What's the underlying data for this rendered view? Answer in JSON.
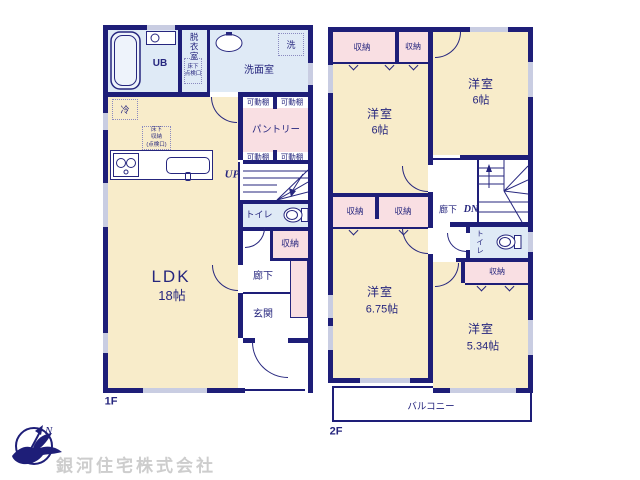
{
  "company": {
    "name": "銀河住宅株式会社"
  },
  "compass": {
    "north": "N"
  },
  "colors": {
    "wall": "#1e1e78",
    "room_cream": "#f8ecca",
    "closet_pink": "#f9dfe3",
    "bath_blue": "#dfeaf6",
    "window": "#c9cde2",
    "text": "#26267e",
    "watermark": "#cdcdcd"
  },
  "floor1": {
    "label": "1F",
    "ub": "UB",
    "dressing_room": "脱衣室",
    "underfloor_hatch": "床下\n点検口",
    "washroom": "洗面室",
    "washer": "洗",
    "fridge": "冷",
    "underfloor_storage": "床下\n収納\n(点検口)",
    "shelf_top_left": "可動棚",
    "shelf_top_right": "可動棚",
    "shelf_bottom_left": "可動棚",
    "shelf_bottom_right": "可動棚",
    "pantry": "パントリー",
    "stairs_up": "UP",
    "toilet": "トイレ",
    "storage": "収納",
    "hallway": "廊下",
    "entrance": "玄関",
    "ldk_name": "LDK",
    "ldk_size": "18帖"
  },
  "floor2": {
    "label": "2F",
    "storage_nw_left": "収納",
    "storage_nw_right": "収納",
    "room_nw_name": "洋室",
    "room_nw_size": "6帖",
    "room_ne_name": "洋室",
    "room_ne_size": "6帖",
    "storage_mid_left": "収納",
    "storage_mid_right": "収納",
    "hallway": "廊下",
    "stairs_down": "DN",
    "toilet": "トイレ",
    "storage_east": "収納",
    "room_sw_name": "洋室",
    "room_sw_size": "6.75帖",
    "room_se_name": "洋室",
    "room_se_size": "5.34帖",
    "balcony": "バルコニー"
  }
}
